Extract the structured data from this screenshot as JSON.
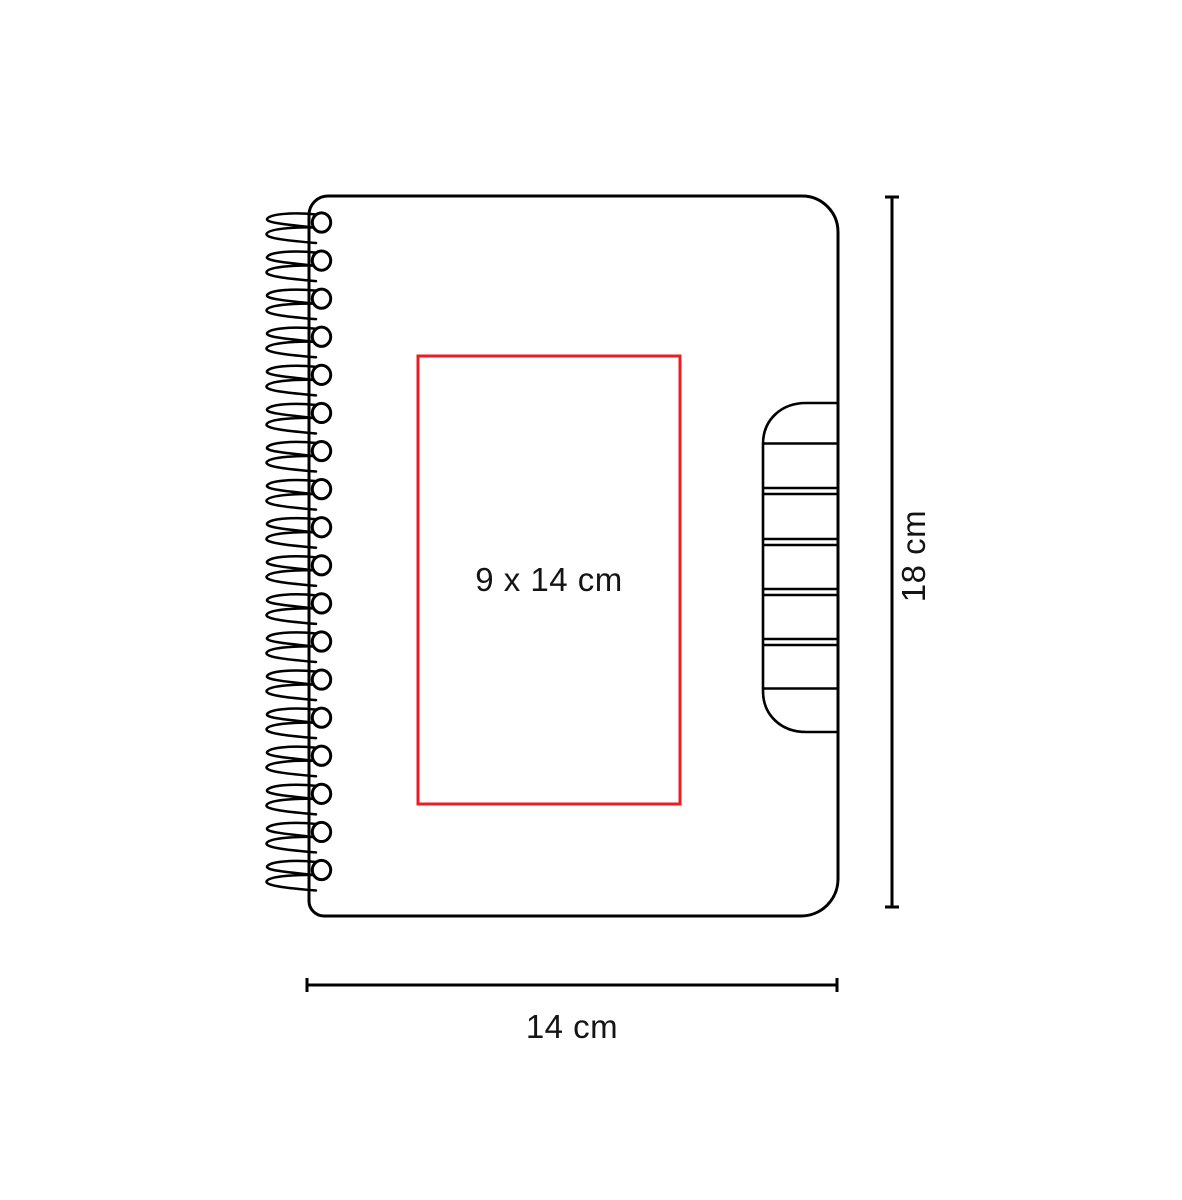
{
  "diagram": {
    "type": "product-dimension-diagram",
    "product": "spiral notebook with side index tab",
    "print_area": {
      "label": "9 x 14 cm"
    },
    "dimensions": {
      "height": "18 cm",
      "width": "14 cm"
    },
    "colors": {
      "line": "#000000",
      "print_area_outline": "#ed1c24",
      "background": "#ffffff"
    }
  }
}
